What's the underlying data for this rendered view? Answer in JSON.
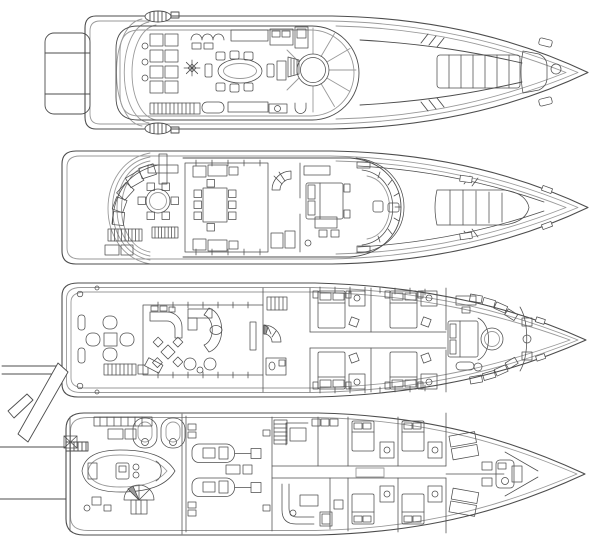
{
  "figure": {
    "type": "yacht-deck-plans",
    "orientation": "bow-right",
    "deck_count": 4
  },
  "colors": {
    "paper": "#ffffff",
    "line": "#4d4d4d",
    "line_soft": "#9a9a9a",
    "line_dark": "#3a3a3a"
  },
  "decks": [
    {
      "id": "sun-deck",
      "label": "Sun deck",
      "features": [
        "aft-platform",
        "radar-arch",
        "sun-loungers",
        "lounge-chairs",
        "compass-rose",
        "oval-dining-table",
        "bar",
        "spa-pool",
        "radial-sunpads",
        "stairs",
        "bow-sunpad",
        "bow-seat",
        "cocktail-table"
      ]
    },
    {
      "id": "bridge-deck",
      "label": "Bridge deck",
      "features": [
        "aft-seating",
        "cross-table",
        "round-table",
        "stairs",
        "sky-lounge",
        "dining-table",
        "sofas",
        "spiral-staircase",
        "captain-cabin",
        "wheelhouse",
        "helm-console",
        "helm-seat",
        "bow-sunpad"
      ]
    },
    {
      "id": "main-deck",
      "label": "Main deck",
      "features": [
        "passerelle",
        "aft-deck-loungers",
        "stairs",
        "salon",
        "bar",
        "l-sofa",
        "curved-sofa",
        "card-table",
        "armchairs",
        "lobby",
        "spiral-staircase",
        "day-head",
        "guest-cabin",
        "guest-cabin",
        "guest-cabin",
        "guest-cabin",
        "master-suite",
        "master-bed",
        "round-pod",
        "master-bathroom"
      ]
    },
    {
      "id": "lower-deck",
      "label": "Lower deck",
      "features": [
        "swim-platform",
        "boarding-ladder",
        "tender-garage",
        "tender",
        "jet-ski",
        "jet-ski",
        "spiral-staircase",
        "engine-room",
        "port-engine",
        "starboard-engine",
        "galley",
        "crew-mess",
        "crew-cabin",
        "crew-cabin",
        "crew-cabin",
        "crew-cabin",
        "fore-peak-crew",
        "crew-bathroom"
      ]
    }
  ]
}
